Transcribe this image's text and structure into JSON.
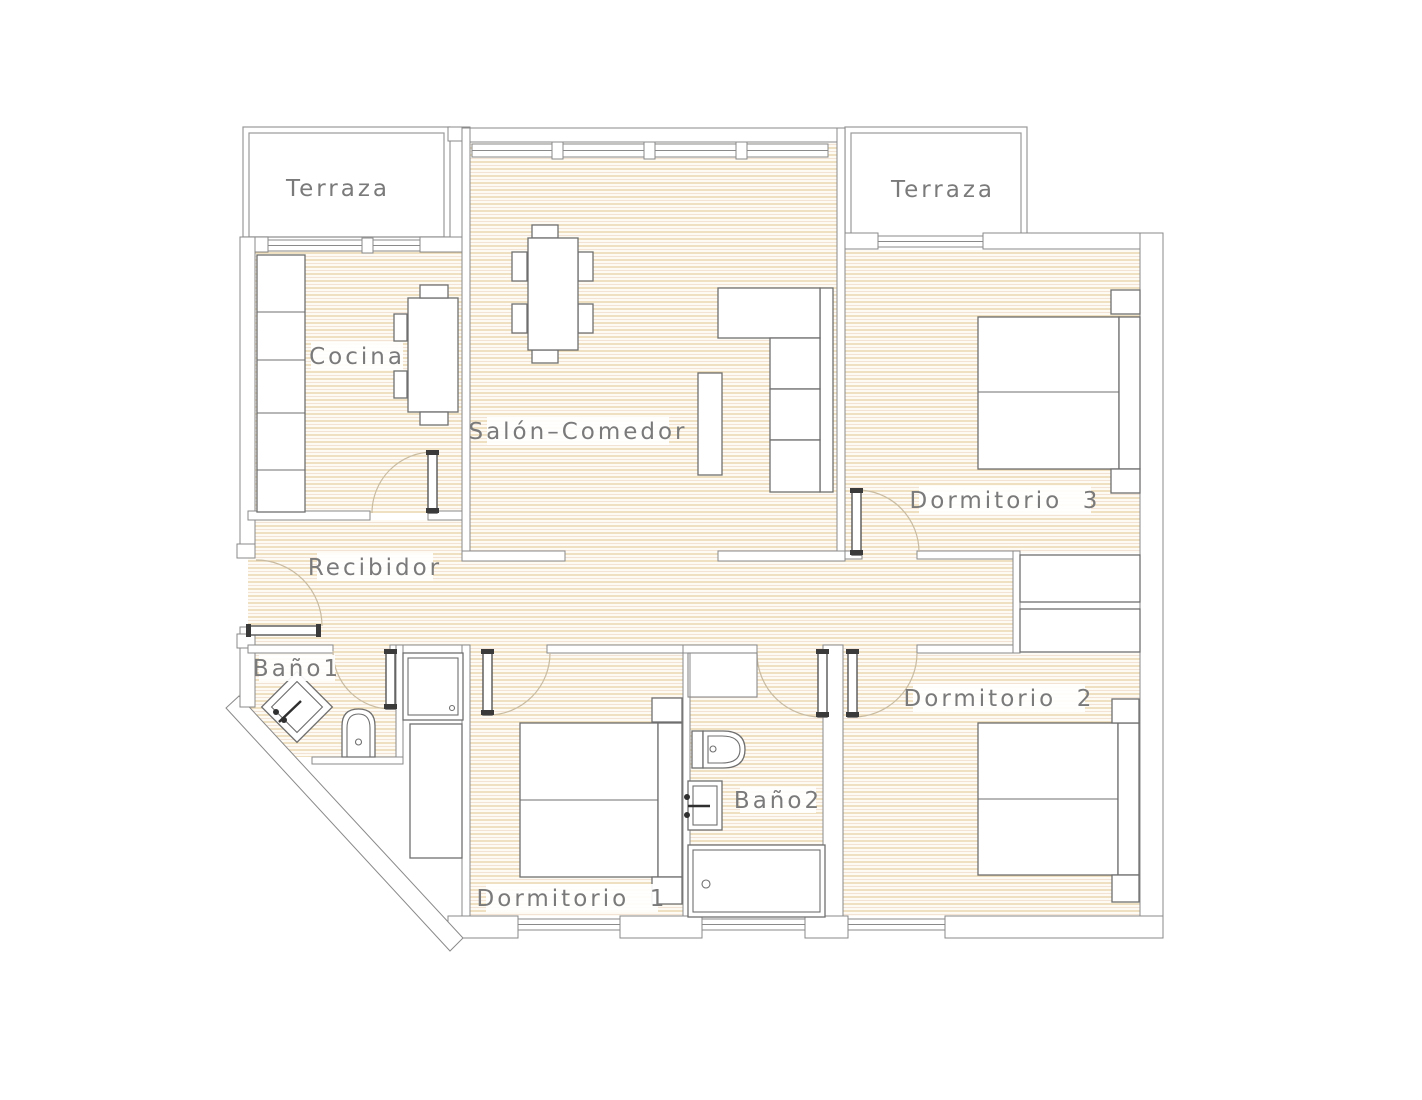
{
  "document": {
    "type": "apartment-floor-plan"
  },
  "rooms": {
    "terraza_left": {
      "label": "Terraza"
    },
    "terraza_right": {
      "label": "Terraza"
    },
    "cocina": {
      "label": "Cocina"
    },
    "salon_comedor": {
      "label": "Salón–Comedor"
    },
    "recibidor": {
      "label": "Recibidor"
    },
    "bano1": {
      "label": "Baño1"
    },
    "bano2": {
      "label": "Baño2"
    },
    "dormitorio1": {
      "label": "Dormitorio  1"
    },
    "dormitorio2": {
      "label": "Dormitorio  2"
    },
    "dormitorio3": {
      "label": "Dormitorio  3"
    }
  },
  "colors": {
    "background": "#ffffff",
    "floor_background": "#fdfbf3",
    "floor_hatch_line": "#e6d1a6",
    "floor_hatch_line_alt": "#f2e3d5",
    "wall_line": "#8a8a8a",
    "furniture_line": "#6f6f6f",
    "door_arc": "#c8bba2",
    "door_leaf_line": "#555555",
    "label_text": "#7a7a7a"
  },
  "fixtures": [
    "kitchen-cabinets-icon",
    "kitchen-table-icon",
    "dining-table-icon",
    "chair-icon",
    "sofa-icon",
    "tv-unit-icon",
    "double-bed-icon",
    "nightstand-icon",
    "wardrobe-icon",
    "closet-icon",
    "washbasin-icon",
    "toilet-icon",
    "shower-icon",
    "bathtub-icon",
    "door-leaf-icon",
    "door-swing-arc-icon",
    "window-icon"
  ]
}
